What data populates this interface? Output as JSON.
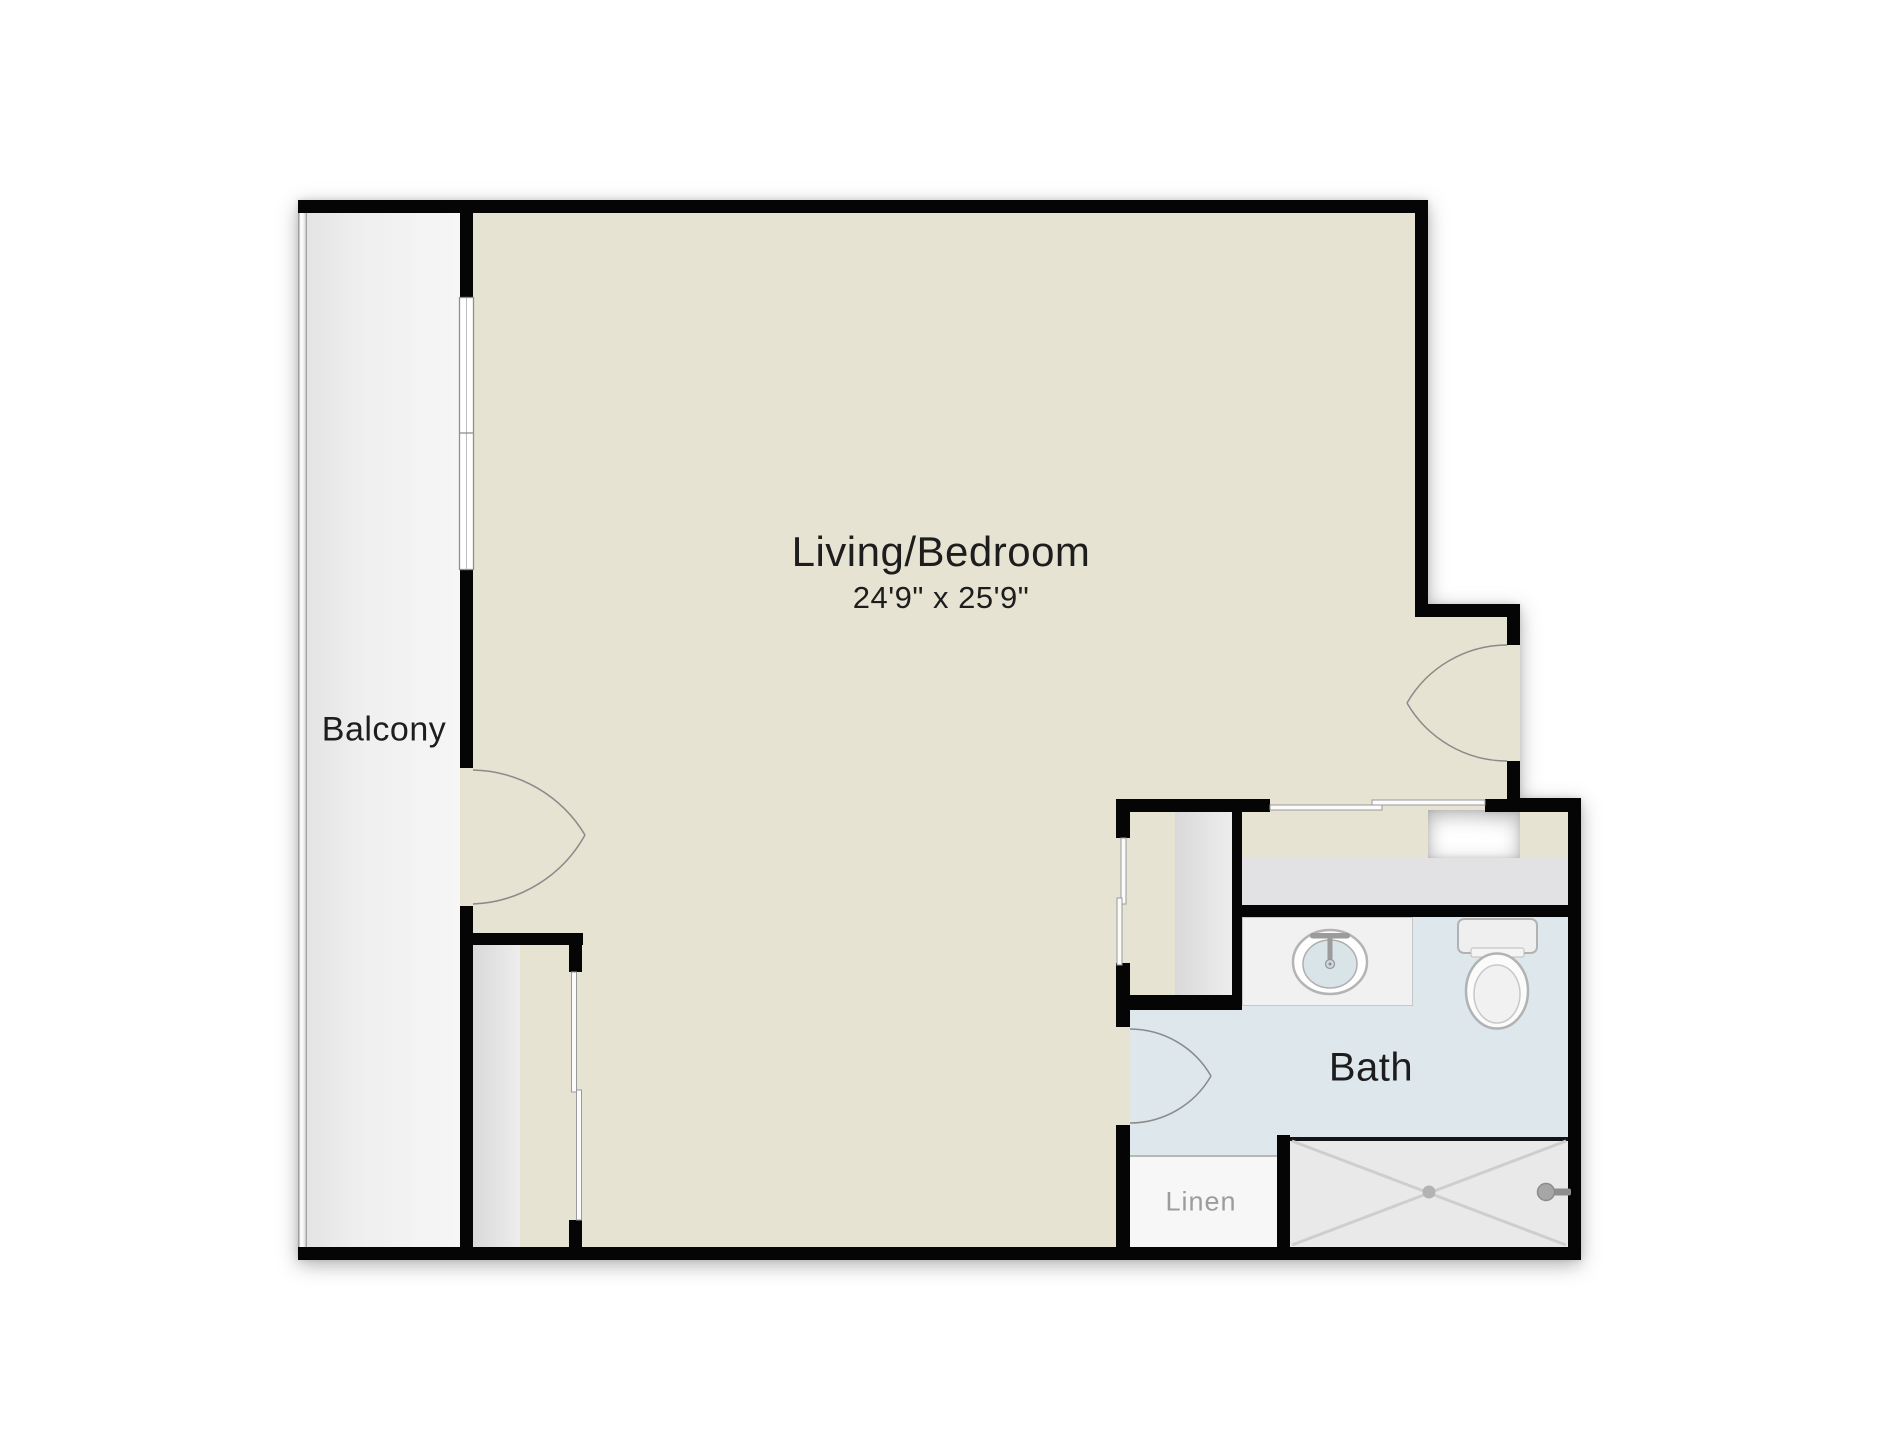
{
  "rooms": {
    "living_bedroom": {
      "label": "Living/Bedroom",
      "dimensions": "24'9\" x 25'9\""
    },
    "balcony": {
      "label": "Balcony"
    },
    "bath": {
      "label": "Bath"
    },
    "linen": {
      "label": "Linen"
    }
  },
  "features": {
    "doors": [
      "balcony-door",
      "entry-door",
      "bath-door"
    ],
    "fixtures": [
      "sink",
      "toilet",
      "shower"
    ],
    "closets": [
      "wardrobe-closet-left",
      "wardrobe-closet-hall",
      "entry-closet",
      "linen-closet"
    ],
    "window_count": 1
  },
  "colors": {
    "wall": "#050505",
    "room_fill": "#e7e3d2",
    "bath_fill": "#dde7ec",
    "balcony_fill": "#f0f0f0",
    "closet_fill": "#e2e2e4",
    "line": "#8f8f8f",
    "label_text": "#1d1d1d",
    "muted_text": "#9c9c9c"
  }
}
